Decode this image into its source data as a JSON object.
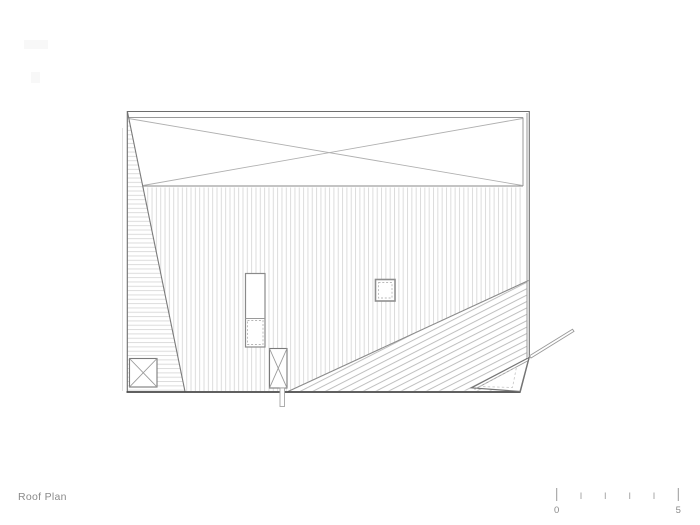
{
  "sheet": {
    "title": "Roof Plan",
    "scale_bar": {
      "start_label": "0",
      "end_label": "5",
      "tick_count": 6
    }
  },
  "colors": {
    "background": "#ffffff",
    "outline": "#6e6e6e",
    "outline_dark": "#4a4a4a",
    "band_line": "#8f8f8f",
    "brace_line": "#b0b0b0",
    "hatch_light": "#dcdcdc",
    "hatch_diagonal": "#bfbfbf",
    "detail_line": "#9a9a9a",
    "dashed_line": "#bababa",
    "annotation": "#8a8a8a"
  }
}
